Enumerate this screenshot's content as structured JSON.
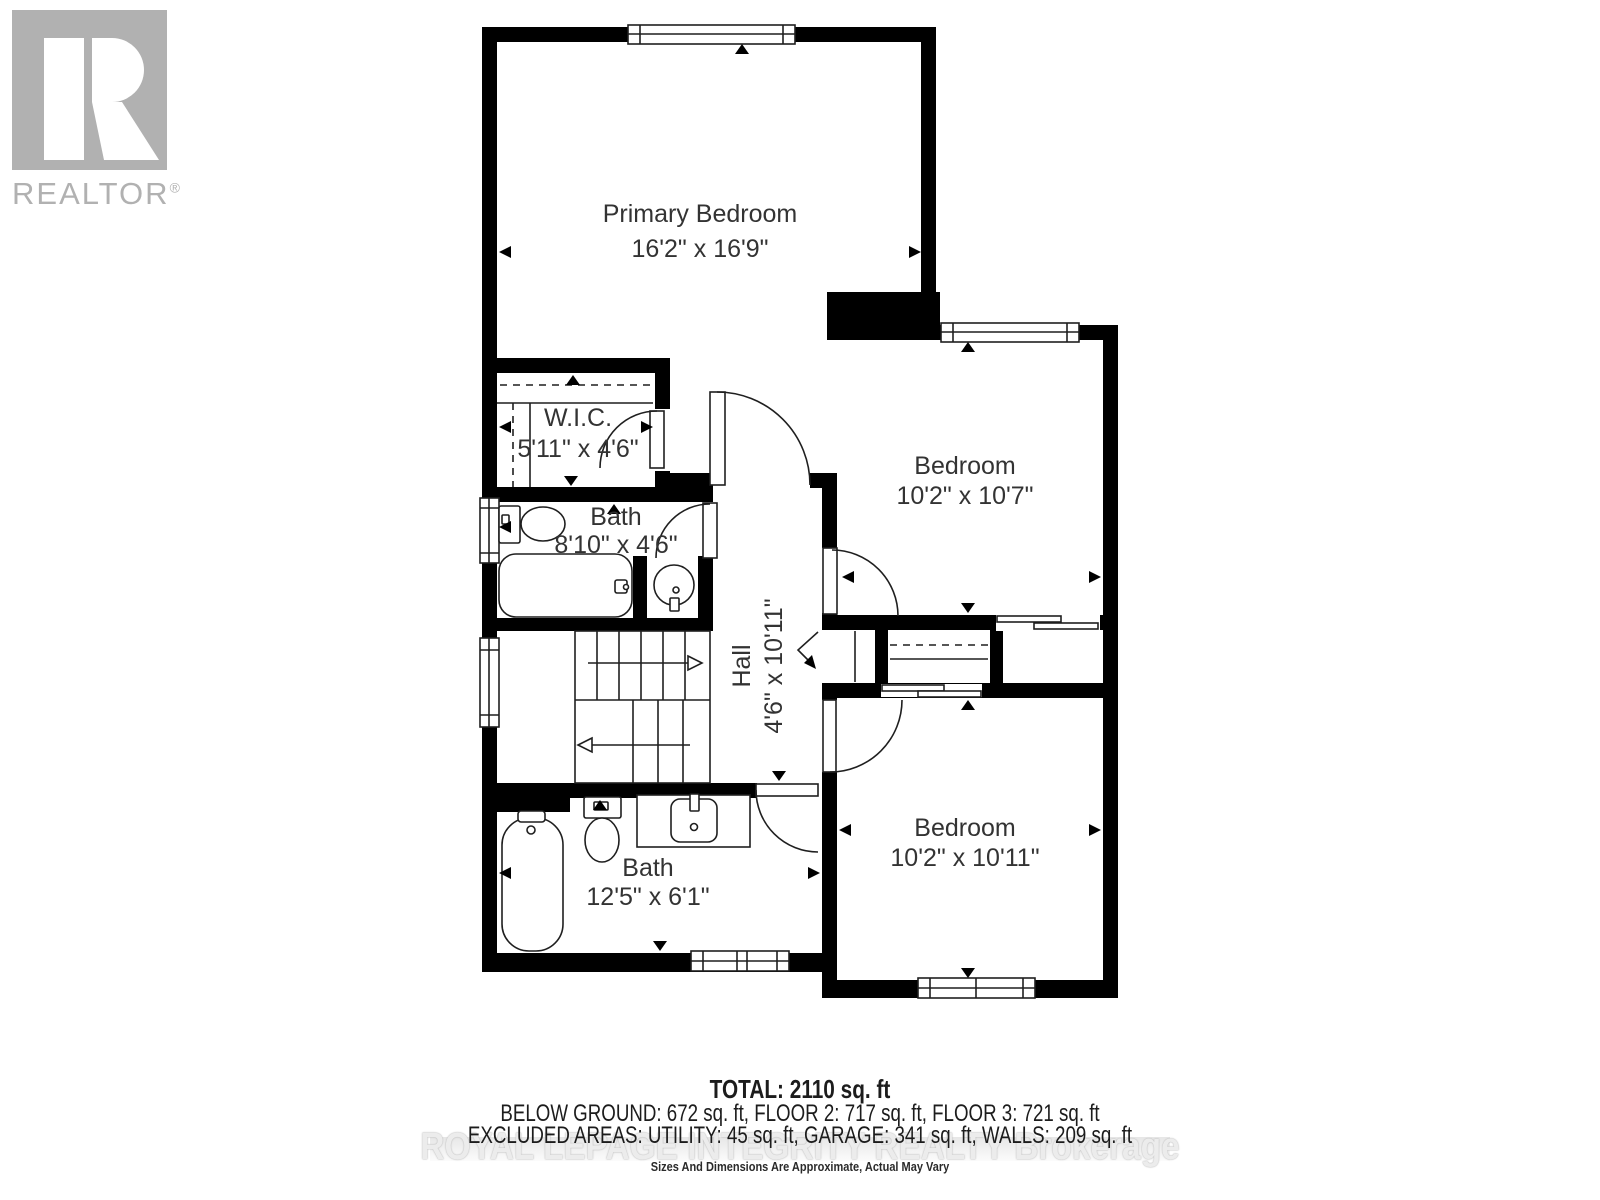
{
  "logo": {
    "brand": "REALTOR",
    "registered": "®"
  },
  "plan": {
    "rooms": [
      {
        "id": "primary-bedroom",
        "name": "Primary Bedroom",
        "dims": "16'2\" x 16'9\""
      },
      {
        "id": "wic",
        "name": "W.I.C.",
        "dims": "5'11\" x 4'6\""
      },
      {
        "id": "bath-upper",
        "name": "Bath",
        "dims": "8'10\" x 4'6\""
      },
      {
        "id": "hall",
        "name": "Hall",
        "dims": "4'6\" x 10'11\""
      },
      {
        "id": "bedroom-upper",
        "name": "Bedroom",
        "dims": "10'2\" x 10'7\""
      },
      {
        "id": "bedroom-lower",
        "name": "Bedroom",
        "dims": "10'2\" x 10'11\""
      },
      {
        "id": "bath-lower",
        "name": "Bath",
        "dims": "12'5\" x 6'1\""
      }
    ]
  },
  "footer": {
    "total": "TOTAL: 2110 sq. ft",
    "floors": "BELOW GROUND: 672 sq. ft, FLOOR 2: 717 sq. ft, FLOOR 3: 721 sq. ft",
    "excluded": "EXCLUDED AREAS: UTILITY: 45 sq. ft, GARAGE: 341 sq. ft, WALLS: 209 sq. ft",
    "watermark": "ROYAL LEPAGE INTEGRITY REALTY Brokerage",
    "disclaimer": "Sizes And Dimensions Are Approximate, Actual May Vary"
  },
  "colors": {
    "wall": "#000000",
    "line": "#2a2a2a",
    "logo_gray": "#b1b1b1",
    "watermark_gray": "#ececec",
    "text": "#1c1c1c"
  }
}
